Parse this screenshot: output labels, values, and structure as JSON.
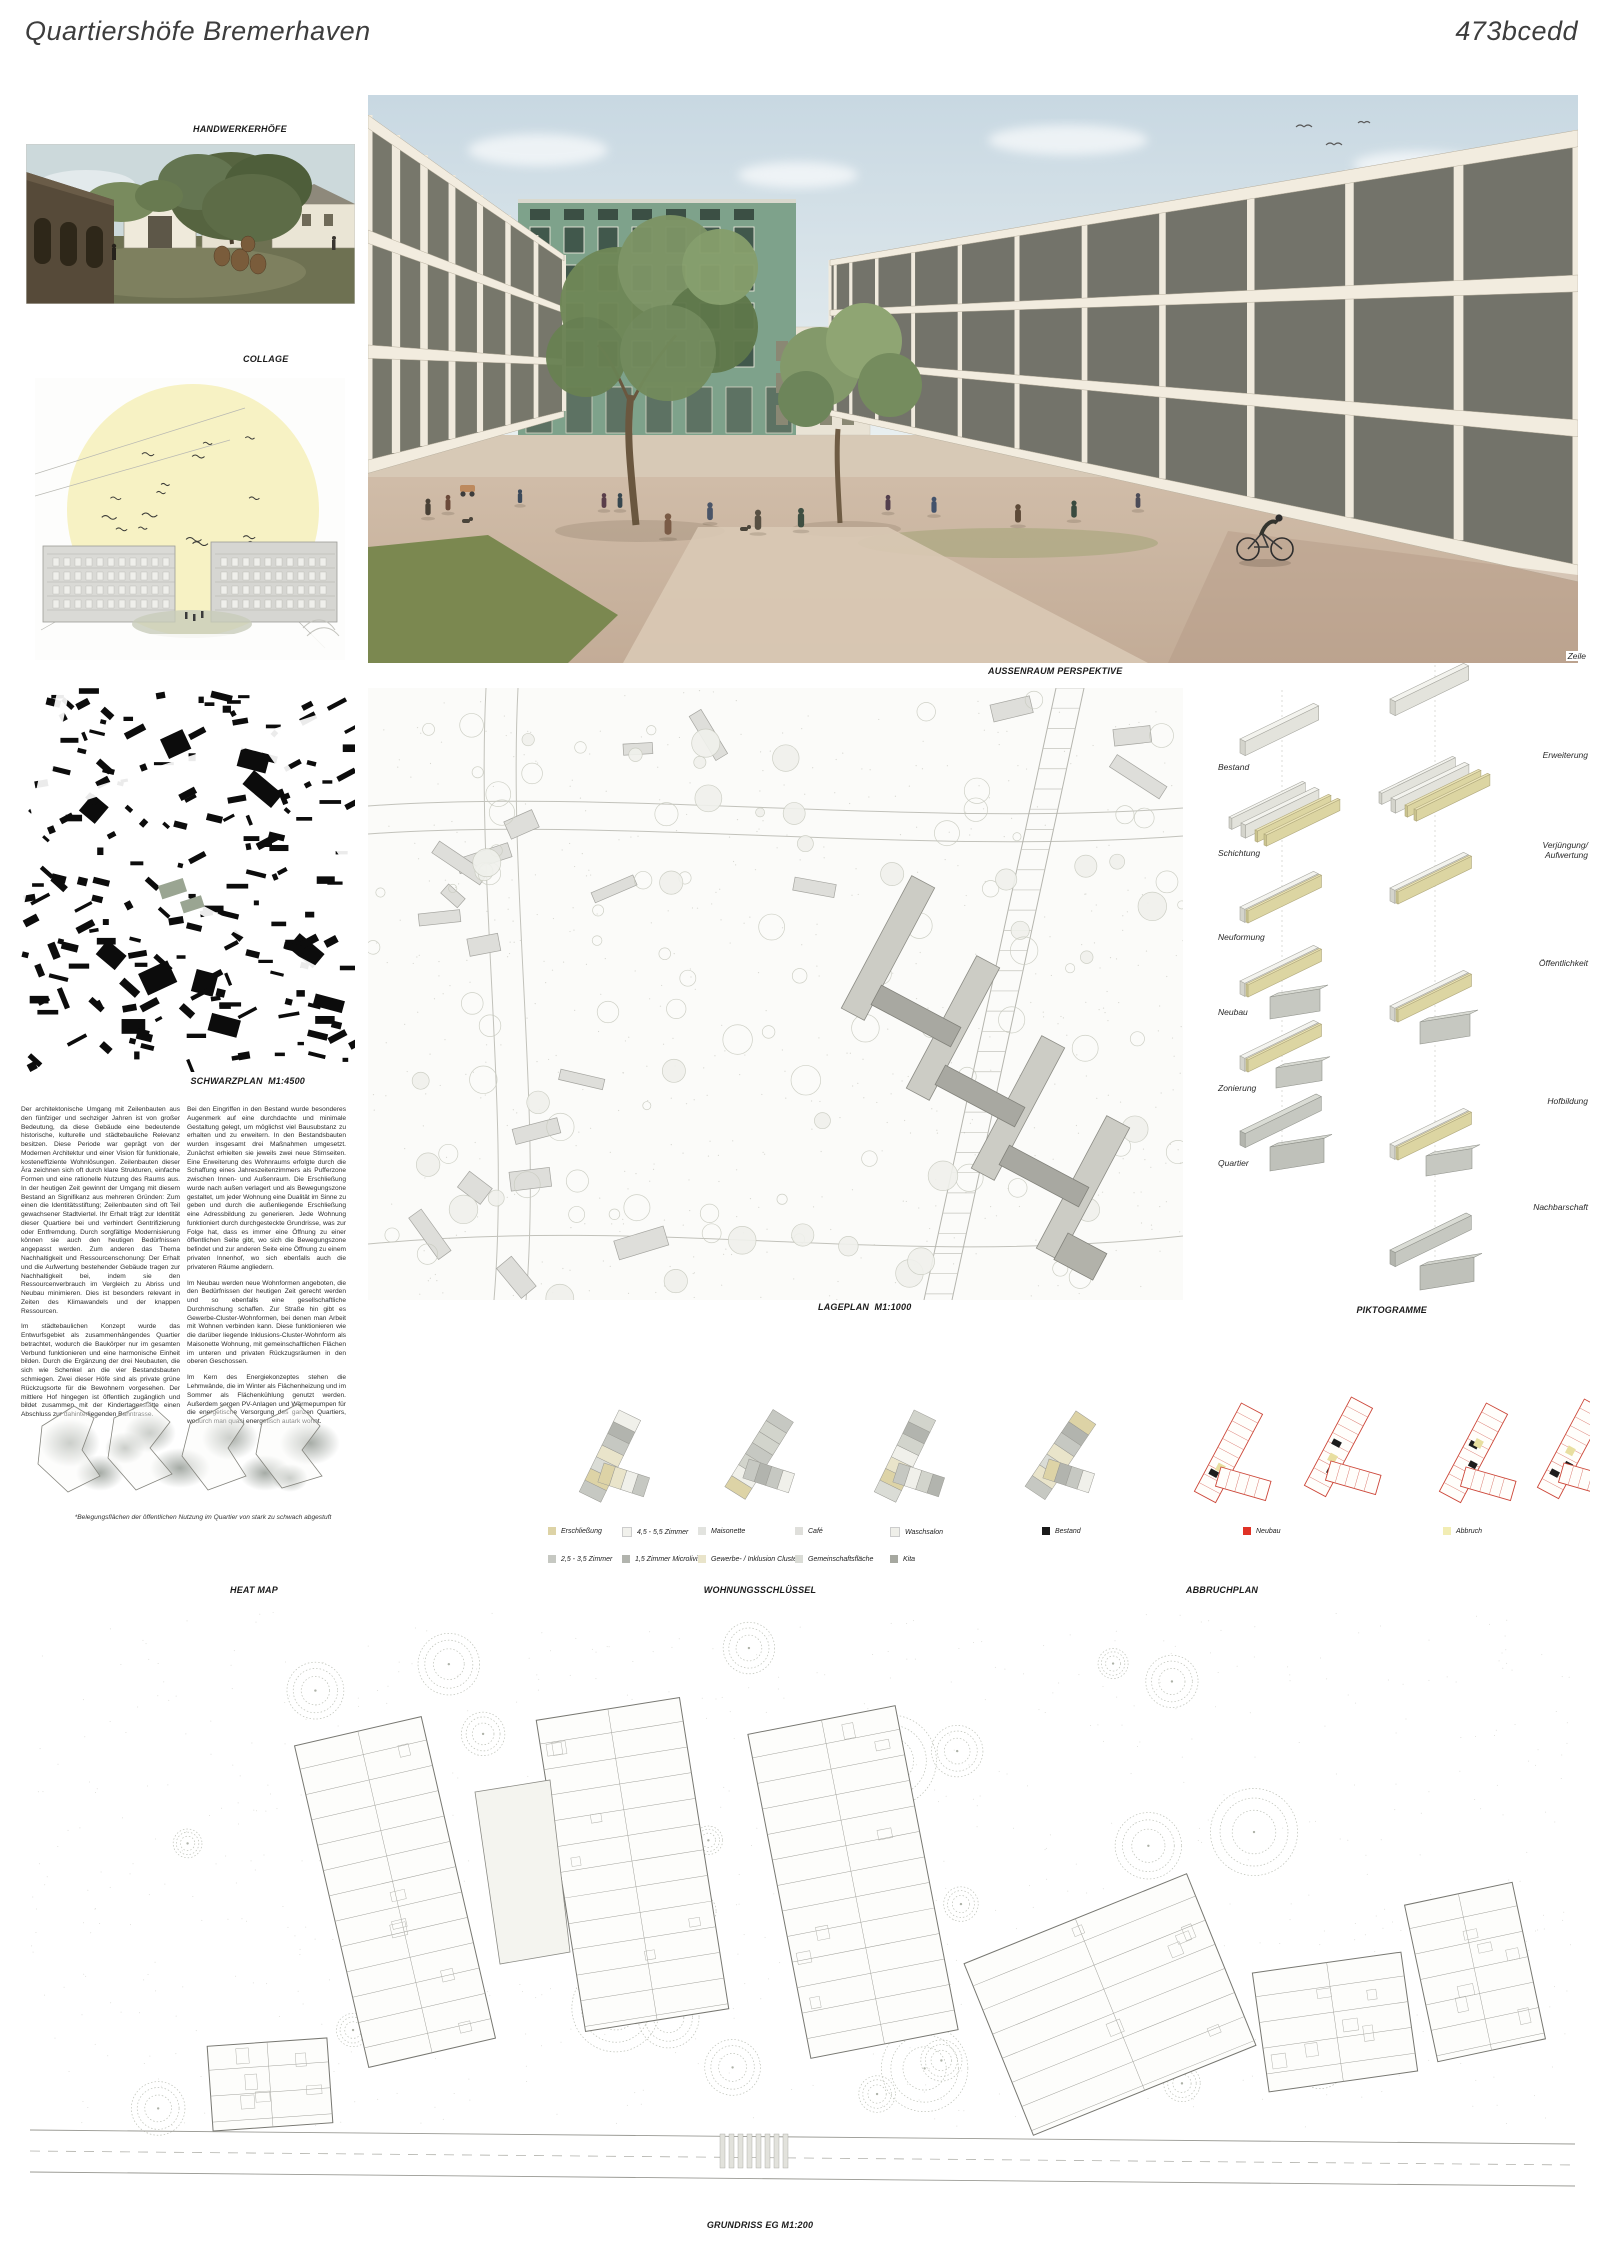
{
  "header": {
    "title": "Quartiershöfe Bremerhaven",
    "code": "473bcedd"
  },
  "panels": {
    "handwerkerhoefe": {
      "caption": "HANDWERKERHÖFE"
    },
    "collage": {
      "caption": "COLLAGE"
    },
    "perspektive": {
      "caption": "AUSSENRAUM PERSPEKTIVE"
    },
    "schwarzplan": {
      "caption": "SCHWARZPLAN  M1:4500"
    },
    "lageplan": {
      "caption": "LAGEPLAN  M1:1000"
    },
    "piktogramme": {
      "caption": "PIKTOGRAMME",
      "top_label": "Zeile",
      "left_labels": [
        "Bestand",
        "Schichtung",
        "Neuformung",
        "Neubau",
        "Zonierung",
        "Quartier"
      ],
      "right_labels": [
        "Erweiterung",
        "Verjüngung/\nAufwertung",
        "Öffentlichkeit",
        "Hofbildung",
        "Nachbarschaft"
      ]
    },
    "heatmap": {
      "caption": "HEAT MAP",
      "note": "*Belegungsflächen der öffentlichen Nutzung im Quartier von stark zu schwach abgestuft"
    },
    "wohnungsschluessel": {
      "caption": "WOHNUNGSSCHLÜSSEL",
      "legend_row1": [
        {
          "label": "Erschließung",
          "color": "#ddd3a6"
        },
        {
          "label": "4,5 - 5,5 Zimmer",
          "color": "#f1f1ec"
        },
        {
          "label": "Maisonette",
          "color": "#e2e3df"
        },
        {
          "label": "Café",
          "color": "#dfdfdb"
        },
        {
          "label": "Waschsalon",
          "color": "#efefe9"
        }
      ],
      "legend_row2": [
        {
          "label": "2,5 - 3,5 Zimmer",
          "color": "#c6c8c2"
        },
        {
          "label": "1,5 Zimmer Microliving",
          "color": "#b2b4ae"
        },
        {
          "label": "Gewerbe- / Inklusion Cluster",
          "color": "#e9e4ca"
        },
        {
          "label": "Gemeinschaftsfläche",
          "color": "#dadcd6"
        },
        {
          "label": "Kita",
          "color": "#a6a8a0"
        }
      ]
    },
    "abbruchplan": {
      "caption": "ABBRUCHPLAN",
      "legend": [
        {
          "label": "Bestand",
          "color": "#1a1a1a"
        },
        {
          "label": "Neubau",
          "color": "#e03226"
        },
        {
          "label": "Abbruch",
          "color": "#f2edb4"
        }
      ]
    },
    "grundriss": {
      "caption": "GRUNDRISS EG M1:200"
    }
  },
  "text_columns": {
    "col1_p1": "Der architektonische Umgang mit Zeilenbauten aus den fünfziger und sechziger Jahren ist von großer Bedeutung, da diese Gebäude eine bedeutende historische, kulturelle und städtebauliche Relevanz besitzen. Diese Periode war geprägt von der Modernen Architektur und einer Vision für funktionale, kosteneffiziente Wohnlösungen. Zeilenbauten dieser Ära zeichnen sich oft durch klare Strukturen, einfache Formen und eine rationelle Nutzung des Raums aus. In der heutigen Zeit gewinnt der Umgang mit diesem Bestand an Signifikanz aus mehreren Gründen: Zum einen die Identitätsstiftung; Zeilenbauten sind oft Teil gewachsener Stadtviertel. Ihr Erhalt trägt zur Identität dieser Quartiere bei und verhindert Gentrifizierung oder Entfremdung. Durch sorgfältige Modernisierung können sie auch den heutigen Bedürfnissen angepasst werden. Zum anderen das Thema Nachhaltigkeit und Ressourcenschonung: Der Erhalt und die Aufwertung bestehender Gebäude tragen zur Nachhaltigkeit bei, indem sie den Ressourcenverbrauch im Vergleich zu Abriss und Neubau minimieren. Dies ist besonders relevant in Zeiten des Klimawandels und der knappen Ressourcen.",
    "col1_p2": "Im städtebaulichen Konzept wurde das Entwurfsgebiet als zusammenhängendes Quartier betrachtet, wodurch die Baukörper nur im gesamten Verbund funktionieren und eine harmonische Einheit bilden. Durch die Ergänzung der drei Neubauten, die sich wie Schenkel an die vier Bestandsbauten schmiegen. Zwei dieser Höfe sind als private grüne Rückzugsorte für die Bewohnern vorgesehen. Der mittlere Hof hingegen ist öffentlich zugänglich und bildet zusammen mit der Kindertagesstätte einen Abschluss zur dahinterliegenden Bahntrasse.",
    "col2_p1": "Bei den Eingriffen in den Bestand wurde besonderes Augenmerk auf eine durchdachte und minimale Gestaltung gelegt, um möglichst viel Bausubstanz zu erhalten und zu erweitern. In den Bestandsbauten wurden insgesamt drei Maßnahmen umgesetzt. Zunächst erhielten sie jeweils zwei neue Stirnseiten. Eine Erweiterung des Wohnraums erfolgte durch die Schaffung eines Jahreszeitenzimmers als Pufferzone zwischen Innen- und Außenraum. Die Erschließung wurde nach außen verlagert und als Bewegungszone gestaltet, um jeder Wohnung eine Dualität im Sinne zu geben und durch die außenliegende Erschließung eine Adressbildung zu generieren. Jede Wohnung funktioniert durch durchgesteckte Grundrisse, was zur Folge hat, dass es immer eine Öffnung zu einer öffentlichen Seite gibt, wo sich die Bewegungszone befindet und zur anderen Seite eine Öffnung zu einem privaten Innenhof, wo sich ebenfalls auch die privateren Räume angliedern.",
    "col2_p2": "Im Neubau werden neue Wohnformen angeboten, die den Bedürfnissen der heutigen Zeit gerecht werden und so ebenfalls eine gesellschaftliche Durchmischung schaffen. Zur Straße hin gibt es Gewerbe-Cluster-Wohnformen, bei denen man Arbeit mit Wohnen verbinden kann. Diese funktionieren wie die darüber liegende Inklusions-Cluster-Wohnform als Maisonette Wohnung, mit gemeinschaftlichen Flächen im unteren und privaten Rückzugsräumen in den oberen Geschossen.",
    "col2_p3": "Im Kern des Energiekonzeptes stehen die Lehmwände, die im Winter als Flächenheizung und im Sommer als Flächenkühlung genutzt werden. Außerdem sorgen PV-Anlagen und Wärmepumpen für die energetische Versorgung des ganzen Quartiers, wodurch man quasi energetisch autark wohnt."
  }
}
